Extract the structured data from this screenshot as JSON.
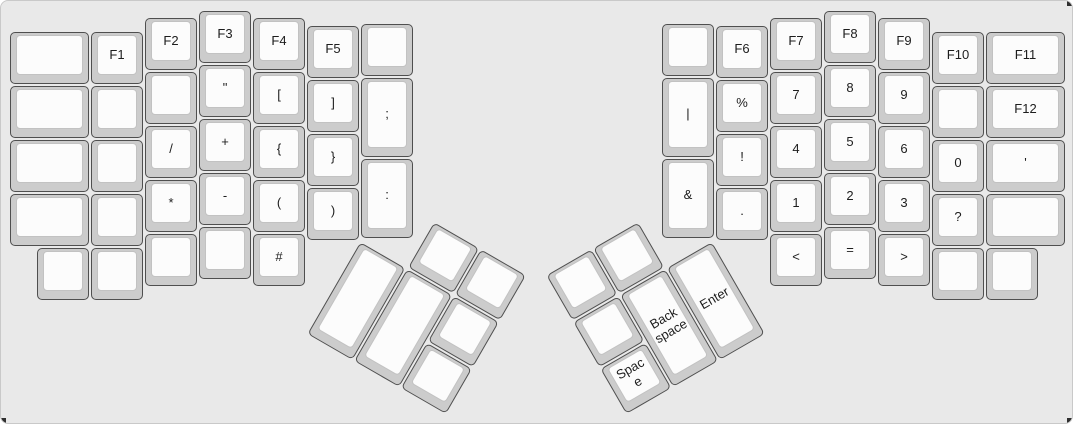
{
  "canvas": {
    "width": 1073,
    "height": 424,
    "background_color": "#e9e9e9",
    "border_color": "#c9c9c9",
    "corner_mark_color": "#2f2f2f"
  },
  "keycap_style": {
    "unit": 54,
    "base_color": "#cccccc",
    "top_color": "#fcfcfc",
    "border_color": "#4f4f4f",
    "top_border_color": "#c2c2c2",
    "label_color": "#1d1d1d"
  },
  "keyboard": {
    "groups": [
      {
        "name": "left-main",
        "x": 0,
        "y": 0,
        "rotation": 0,
        "keys": [
          {
            "name": "blank",
            "label": "",
            "x": 8,
            "y": 30,
            "w": 81,
            "h": 54
          },
          {
            "name": "blank",
            "label": "",
            "x": 8,
            "y": 84,
            "w": 81,
            "h": 54
          },
          {
            "name": "blank",
            "label": "",
            "x": 8,
            "y": 138,
            "w": 81,
            "h": 54
          },
          {
            "name": "blank",
            "label": "",
            "x": 8,
            "y": 192,
            "w": 81,
            "h": 54
          },
          {
            "name": "blank",
            "label": "",
            "x": 35,
            "y": 246,
            "w": 54,
            "h": 54
          },
          {
            "name": "f1",
            "label": "F1",
            "x": 89,
            "y": 30,
            "w": 54,
            "h": 54
          },
          {
            "name": "blank",
            "label": "",
            "x": 89,
            "y": 84,
            "w": 54,
            "h": 54
          },
          {
            "name": "blank",
            "label": "",
            "x": 89,
            "y": 138,
            "w": 54,
            "h": 54
          },
          {
            "name": "blank",
            "label": "",
            "x": 89,
            "y": 192,
            "w": 54,
            "h": 54
          },
          {
            "name": "blank",
            "label": "",
            "x": 89,
            "y": 246,
            "w": 54,
            "h": 54
          },
          {
            "name": "f2",
            "label": "F2",
            "x": 143,
            "y": 16,
            "w": 54,
            "h": 54
          },
          {
            "name": "blank",
            "label": "",
            "x": 143,
            "y": 70,
            "w": 54,
            "h": 54
          },
          {
            "name": "slash",
            "label": "/",
            "x": 143,
            "y": 124,
            "w": 54,
            "h": 54
          },
          {
            "name": "asterisk",
            "label": "*",
            "x": 143,
            "y": 178,
            "w": 54,
            "h": 54
          },
          {
            "name": "blank",
            "label": "",
            "x": 143,
            "y": 232,
            "w": 54,
            "h": 54
          },
          {
            "name": "f3",
            "label": "F3",
            "x": 197,
            "y": 9,
            "w": 54,
            "h": 54
          },
          {
            "name": "double-quote",
            "label": "\"",
            "x": 197,
            "y": 63,
            "w": 54,
            "h": 54
          },
          {
            "name": "plus",
            "label": "+",
            "x": 197,
            "y": 117,
            "w": 54,
            "h": 54
          },
          {
            "name": "minus",
            "label": "-",
            "x": 197,
            "y": 171,
            "w": 54,
            "h": 54
          },
          {
            "name": "blank",
            "label": "",
            "x": 197,
            "y": 225,
            "w": 54,
            "h": 54
          },
          {
            "name": "f4",
            "label": "F4",
            "x": 251,
            "y": 16,
            "w": 54,
            "h": 54
          },
          {
            "name": "bracket-open",
            "label": "[",
            "x": 251,
            "y": 70,
            "w": 54,
            "h": 54
          },
          {
            "name": "brace-open",
            "label": "{",
            "x": 251,
            "y": 124,
            "w": 54,
            "h": 54
          },
          {
            "name": "paren-open",
            "label": "(",
            "x": 251,
            "y": 178,
            "w": 54,
            "h": 54
          },
          {
            "name": "hash",
            "label": "#",
            "x": 251,
            "y": 232,
            "w": 54,
            "h": 54
          },
          {
            "name": "f5",
            "label": "F5",
            "x": 305,
            "y": 24,
            "w": 54,
            "h": 54
          },
          {
            "name": "bracket-close",
            "label": "]",
            "x": 305,
            "y": 78,
            "w": 54,
            "h": 54
          },
          {
            "name": "brace-close",
            "label": "}",
            "x": 305,
            "y": 132,
            "w": 54,
            "h": 54
          },
          {
            "name": "paren-close",
            "label": ")",
            "x": 305,
            "y": 186,
            "w": 54,
            "h": 54
          },
          {
            "name": "blank",
            "label": "",
            "x": 359,
            "y": 22,
            "w": 54,
            "h": 54
          },
          {
            "name": "semicolon",
            "label": ";",
            "x": 359,
            "y": 76,
            "w": 54,
            "h": 81
          },
          {
            "name": "colon",
            "label": ":",
            "x": 359,
            "y": 157,
            "w": 54,
            "h": 81
          }
        ]
      },
      {
        "name": "right-main",
        "x": 0,
        "y": 0,
        "rotation": 0,
        "keys": [
          {
            "name": "blank",
            "label": "",
            "x": 660,
            "y": 22,
            "w": 54,
            "h": 54
          },
          {
            "name": "pipe",
            "label": "|",
            "x": 660,
            "y": 76,
            "w": 54,
            "h": 81
          },
          {
            "name": "ampersand",
            "label": "&",
            "x": 660,
            "y": 157,
            "w": 54,
            "h": 81
          },
          {
            "name": "f6",
            "label": "F6",
            "x": 714,
            "y": 24,
            "w": 54,
            "h": 54
          },
          {
            "name": "percent",
            "label": "%",
            "x": 714,
            "y": 78,
            "w": 54,
            "h": 54
          },
          {
            "name": "exclamation",
            "label": "!",
            "x": 714,
            "y": 132,
            "w": 54,
            "h": 54
          },
          {
            "name": "period",
            "label": ".",
            "x": 714,
            "y": 186,
            "w": 54,
            "h": 54
          },
          {
            "name": "f7",
            "label": "F7",
            "x": 768,
            "y": 16,
            "w": 54,
            "h": 54
          },
          {
            "name": "num-7",
            "label": "7",
            "x": 768,
            "y": 70,
            "w": 54,
            "h": 54
          },
          {
            "name": "num-4",
            "label": "4",
            "x": 768,
            "y": 124,
            "w": 54,
            "h": 54
          },
          {
            "name": "num-1",
            "label": "1",
            "x": 768,
            "y": 178,
            "w": 54,
            "h": 54
          },
          {
            "name": "less-than",
            "label": "<",
            "x": 768,
            "y": 232,
            "w": 54,
            "h": 54
          },
          {
            "name": "f8",
            "label": "F8",
            "x": 822,
            "y": 9,
            "w": 54,
            "h": 54
          },
          {
            "name": "num-8",
            "label": "8",
            "x": 822,
            "y": 63,
            "w": 54,
            "h": 54
          },
          {
            "name": "num-5",
            "label": "5",
            "x": 822,
            "y": 117,
            "w": 54,
            "h": 54
          },
          {
            "name": "num-2",
            "label": "2",
            "x": 822,
            "y": 171,
            "w": 54,
            "h": 54
          },
          {
            "name": "equals",
            "label": "=",
            "x": 822,
            "y": 225,
            "w": 54,
            "h": 54
          },
          {
            "name": "f9",
            "label": "F9",
            "x": 876,
            "y": 16,
            "w": 54,
            "h": 54
          },
          {
            "name": "num-9",
            "label": "9",
            "x": 876,
            "y": 70,
            "w": 54,
            "h": 54
          },
          {
            "name": "num-6",
            "label": "6",
            "x": 876,
            "y": 124,
            "w": 54,
            "h": 54
          },
          {
            "name": "num-3",
            "label": "3",
            "x": 876,
            "y": 178,
            "w": 54,
            "h": 54
          },
          {
            "name": "greater-than",
            "label": ">",
            "x": 876,
            "y": 232,
            "w": 54,
            "h": 54
          },
          {
            "name": "f10",
            "label": "F10",
            "x": 930,
            "y": 30,
            "w": 54,
            "h": 54
          },
          {
            "name": "blank",
            "label": "",
            "x": 930,
            "y": 84,
            "w": 54,
            "h": 54
          },
          {
            "name": "num-0",
            "label": "0",
            "x": 930,
            "y": 138,
            "w": 54,
            "h": 54
          },
          {
            "name": "question",
            "label": "?",
            "x": 930,
            "y": 192,
            "w": 54,
            "h": 54
          },
          {
            "name": "blank",
            "label": "",
            "x": 930,
            "y": 246,
            "w": 54,
            "h": 54
          },
          {
            "name": "f11",
            "label": "F11",
            "x": 984,
            "y": 30,
            "w": 81,
            "h": 54
          },
          {
            "name": "f12",
            "label": "F12",
            "x": 984,
            "y": 84,
            "w": 81,
            "h": 54
          },
          {
            "name": "apostrophe",
            "label": "'",
            "x": 984,
            "y": 138,
            "w": 81,
            "h": 54
          },
          {
            "name": "blank",
            "label": "",
            "x": 984,
            "y": 192,
            "w": 81,
            "h": 54
          },
          {
            "name": "blank",
            "label": "",
            "x": 984,
            "y": 246,
            "w": 54,
            "h": 54
          }
        ]
      },
      {
        "name": "left-thumb-cluster",
        "x": 386,
        "y": 193,
        "rotation": 30,
        "keys": [
          {
            "name": "blank",
            "label": "",
            "x": 54,
            "y": 0,
            "w": 54,
            "h": 54
          },
          {
            "name": "blank",
            "label": "",
            "x": 108,
            "y": 0,
            "w": 54,
            "h": 54
          },
          {
            "name": "blank",
            "label": "",
            "x": 0,
            "y": 54,
            "w": 54,
            "h": 108
          },
          {
            "name": "blank",
            "label": "",
            "x": 54,
            "y": 54,
            "w": 54,
            "h": 108
          },
          {
            "name": "blank",
            "label": "",
            "x": 108,
            "y": 54,
            "w": 54,
            "h": 54
          },
          {
            "name": "blank",
            "label": "",
            "x": 108,
            "y": 108,
            "w": 54,
            "h": 54
          }
        ]
      },
      {
        "name": "right-thumb-cluster",
        "x": 544,
        "y": 274,
        "rotation": -30,
        "keys": [
          {
            "name": "blank",
            "label": "",
            "x": 0,
            "y": 0,
            "w": 54,
            "h": 54
          },
          {
            "name": "blank",
            "label": "",
            "x": 54,
            "y": 0,
            "w": 54,
            "h": 54
          },
          {
            "name": "blank",
            "label": "",
            "x": 0,
            "y": 54,
            "w": 54,
            "h": 54
          },
          {
            "name": "backspace",
            "label": "Back space",
            "x": 54,
            "y": 54,
            "w": 54,
            "h": 108
          },
          {
            "name": "enter",
            "label": "Enter",
            "x": 108,
            "y": 54,
            "w": 54,
            "h": 108
          },
          {
            "name": "space",
            "label": "Space",
            "x": 0,
            "y": 108,
            "w": 54,
            "h": 54
          }
        ]
      }
    ]
  }
}
